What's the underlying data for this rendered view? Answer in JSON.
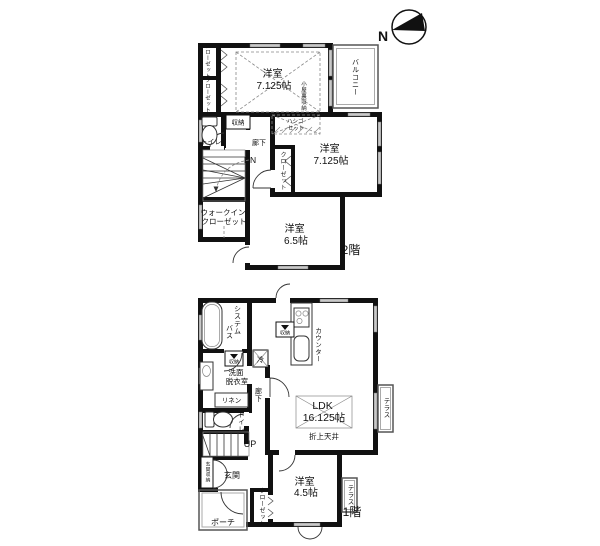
{
  "compass": {
    "north": "N"
  },
  "colors": {
    "wall": "#111111",
    "window": "#c9c9c9",
    "thin_line": "#555555",
    "dash": "#888888"
  },
  "floor2": {
    "floor_label": "2階",
    "bedroom_top": {
      "name": "洋室",
      "size": "7.125帖"
    },
    "attic_storage": "小屋裏収納",
    "closet_top_a": "クローゼット",
    "closet_top_b": "クローゼット",
    "balcony": "バルコニー",
    "toilet": "トイレ",
    "storage": "収納",
    "hallway": "廊下",
    "stairs_label": "DN",
    "ladder_line1": "ハシゴ",
    "ladder_line2": "セット",
    "bedroom_right": {
      "name": "洋室",
      "size": "7.125帖"
    },
    "closet_right": "クローゼット",
    "wic_line1": "ウォークイン",
    "wic_line2": "クローゼット",
    "bedroom_bottom": {
      "name": "洋室",
      "size": "6.5帖"
    }
  },
  "floor1": {
    "floor_label": "1階",
    "bath_line1": "システム",
    "bath_line2": "バス",
    "storage_wash": "収納",
    "storage_kitchen": "収納",
    "fridge": "冷",
    "washroom_line1": "洗面",
    "washroom_line2": "脱衣室",
    "linen": "リネン",
    "hallway": "廊下",
    "toilet": "トイレ",
    "stairs_label": "UP",
    "entrance": "玄関",
    "entrance_storage": "玄関収納",
    "porch": "ポーチ",
    "counter": "カウンター",
    "ldk": {
      "name": "LDK",
      "size": "16.125帖"
    },
    "ceiling_note": "折上天井",
    "bedroom": {
      "name": "洋室",
      "size": "4.5帖"
    },
    "closet": "クローゼット",
    "terrace_ldk": "テラス",
    "terrace_bedroom": "テラス"
  }
}
